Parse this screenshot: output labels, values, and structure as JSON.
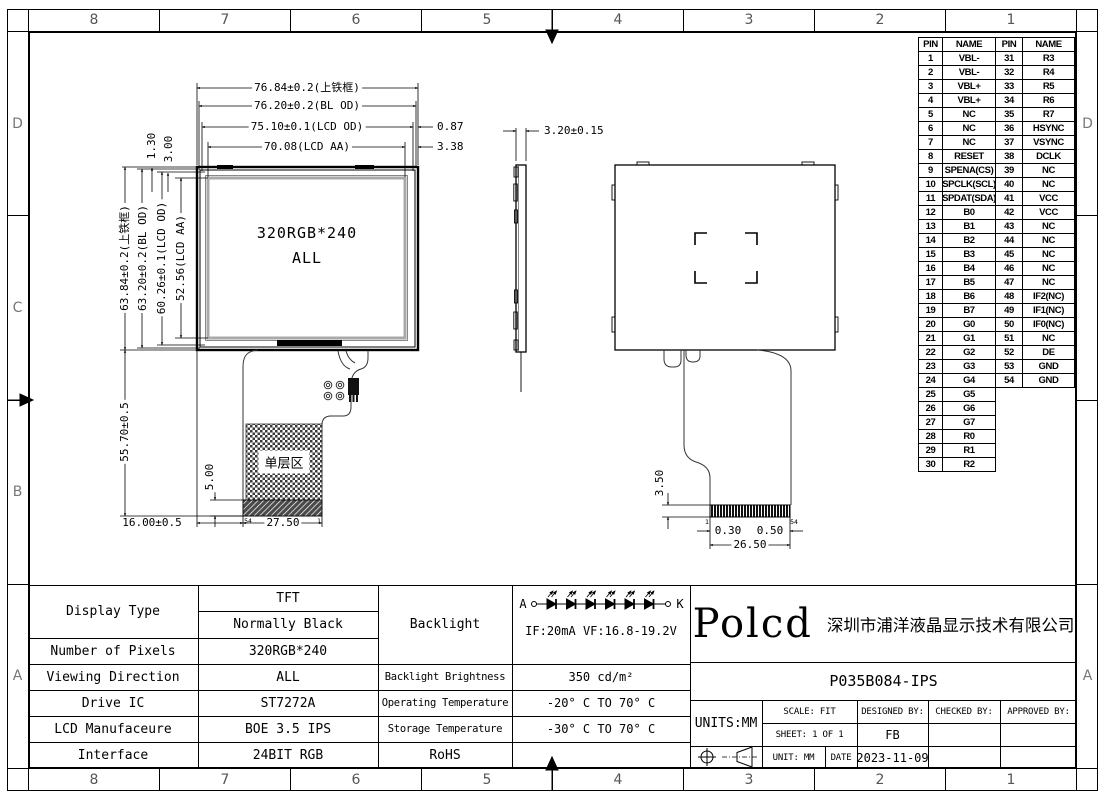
{
  "frame": {
    "columns": [
      "8",
      "7",
      "6",
      "5",
      "4",
      "3",
      "2",
      "1"
    ],
    "rows_left": [
      "D",
      "C",
      "B",
      "A"
    ],
    "rows_right": [
      "D",
      "",
      "",
      "A"
    ]
  },
  "front_view": {
    "dim_top": [
      "76.84±0.2(上铁框)",
      "76.20±0.2(BL OD)",
      "75.10±0.1(LCD OD)",
      "70.08(LCD AA)"
    ],
    "dim_top_right": [
      "0.87",
      "3.38"
    ],
    "dim_top_vert": [
      "1.30",
      "3.00"
    ],
    "dim_left": [
      "63.84±0.2(上铁框)",
      "63.20±0.2(BL OD)",
      "60.26±0.1(LCD OD)",
      "52.56(LCD AA)"
    ],
    "dim_left_lower": "55.70±0.5",
    "dim_bottom": [
      "16.00±0.5",
      "27.50"
    ],
    "dim_strip": "5.00",
    "screen_text1": "320RGB*240",
    "screen_text2": "ALL",
    "fpc_zone_label": "单层区",
    "conn_pin_left": "54",
    "conn_pin_right": "1"
  },
  "side_view": {
    "dim_thickness": "3.20±0.15"
  },
  "back_view": {
    "dim_conn_height": "3.50",
    "dim_pin1": "0.30",
    "dim_pitch": "0.50",
    "dim_conn_width": "26.50",
    "conn_pin_left": "1",
    "conn_pin_right": "54"
  },
  "pin_table": {
    "headers": [
      "PIN",
      "NAME",
      "PIN",
      "NAME"
    ],
    "rows": [
      [
        "1",
        "VBL-",
        "31",
        "R3"
      ],
      [
        "2",
        "VBL-",
        "32",
        "R4"
      ],
      [
        "3",
        "VBL+",
        "33",
        "R5"
      ],
      [
        "4",
        "VBL+",
        "34",
        "R6"
      ],
      [
        "5",
        "NC",
        "35",
        "R7"
      ],
      [
        "6",
        "NC",
        "36",
        "HSYNC"
      ],
      [
        "7",
        "NC",
        "37",
        "VSYNC"
      ],
      [
        "8",
        "RESET",
        "38",
        "DCLK"
      ],
      [
        "9",
        "SPENA(CS)",
        "39",
        "NC"
      ],
      [
        "10",
        "SPCLK(SCL)",
        "40",
        "NC"
      ],
      [
        "11",
        "SPDAT(SDA)",
        "41",
        "VCC"
      ],
      [
        "12",
        "B0",
        "42",
        "VCC"
      ],
      [
        "13",
        "B1",
        "43",
        "NC"
      ],
      [
        "14",
        "B2",
        "44",
        "NC"
      ],
      [
        "15",
        "B3",
        "45",
        "NC"
      ],
      [
        "16",
        "B4",
        "46",
        "NC"
      ],
      [
        "17",
        "B5",
        "47",
        "NC"
      ],
      [
        "18",
        "B6",
        "48",
        "IF2(NC)"
      ],
      [
        "19",
        "B7",
        "49",
        "IF1(NC)"
      ],
      [
        "20",
        "G0",
        "50",
        "IF0(NC)"
      ],
      [
        "21",
        "G1",
        "51",
        "NC"
      ],
      [
        "22",
        "G2",
        "52",
        "DE"
      ],
      [
        "23",
        "G3",
        "53",
        "GND"
      ],
      [
        "24",
        "G4",
        "54",
        "GND"
      ],
      [
        "25",
        "G5",
        "",
        ""
      ],
      [
        "26",
        "G6",
        "",
        ""
      ],
      [
        "27",
        "G7",
        "",
        ""
      ],
      [
        "28",
        "R0",
        "",
        ""
      ],
      [
        "29",
        "R1",
        "",
        ""
      ],
      [
        "30",
        "R2",
        "",
        ""
      ]
    ]
  },
  "spec_table": {
    "display_type": {
      "label": "Display Type",
      "value1": "TFT",
      "value2": "Normally Black"
    },
    "pixels": {
      "label": "Number of Pixels",
      "value": "320RGB*240"
    },
    "viewing": {
      "label": "Viewing Direction",
      "value": "ALL"
    },
    "drive_ic": {
      "label": "Drive IC",
      "value": "ST7272A"
    },
    "manufacture": {
      "label": "LCD Manufaceure",
      "value": "BOE 3.5 IPS"
    },
    "interface": {
      "label": "Interface",
      "value": "24BIT RGB"
    },
    "backlight": {
      "label": "Backlight",
      "anode": "A",
      "cathode": "K",
      "spec": "IF:20mA  VF:16.8-19.2V"
    },
    "brightness": {
      "label": "Backlight Brightness",
      "value": "350 cd/m²"
    },
    "op_temp": {
      "label": "Operating Temperature",
      "value": "-20° C TO 70° C"
    },
    "st_temp": {
      "label": "Storage Temperature",
      "value": "-30° C TO 70° C"
    },
    "rohs": {
      "label": "RoHS"
    }
  },
  "title_block": {
    "logo": "Polcd",
    "company": "深圳市浦洋液晶显示技术有限公司",
    "part_number": "P035B084-IPS",
    "units": "UNITS:MM",
    "scale": "SCALE: FIT",
    "sheet": "SHEET: 1 OF 1",
    "unit": "UNIT: MM",
    "date_label": "DATE",
    "date": "2023-11-09",
    "designed_by": "DESIGNED BY:",
    "designer": "FB",
    "checked_by": "CHECKED BY:",
    "approved_by": "APPROVED BY:"
  }
}
